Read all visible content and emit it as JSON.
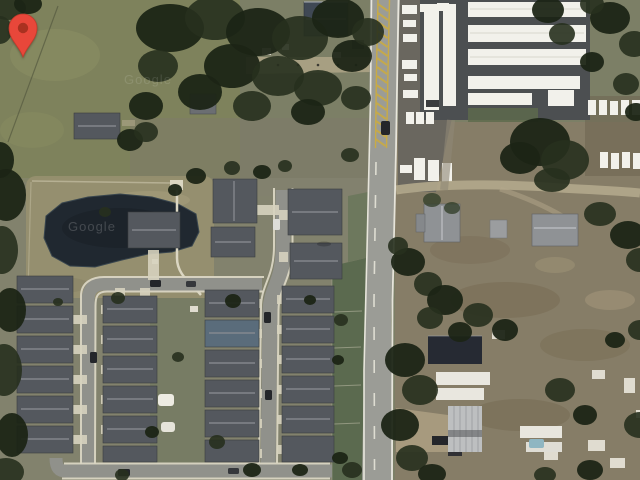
{
  "map": {
    "view": "satellite",
    "watermark": {
      "primary": "Google",
      "secondary": "Google"
    },
    "marker": {
      "fill": "#E8473A",
      "dot": "#A93120"
    }
  },
  "palette": {
    "ground_base": "#7C7F66",
    "field_green": "#7E825C",
    "pond": "#202830",
    "road_asphalt": "#9B9C96",
    "road_median_yellow": "#C9AB45",
    "street_gray": "#90918B",
    "sidewalk": "#D9D5C3",
    "roof_dark": "#54585E",
    "storage_white": "#F2F1EB",
    "storage_asphalt": "#4C4F51",
    "dirt_tan": "#B3A88C",
    "grass_strip": "#5B6A4F",
    "tree_dark": "#1C2415"
  }
}
